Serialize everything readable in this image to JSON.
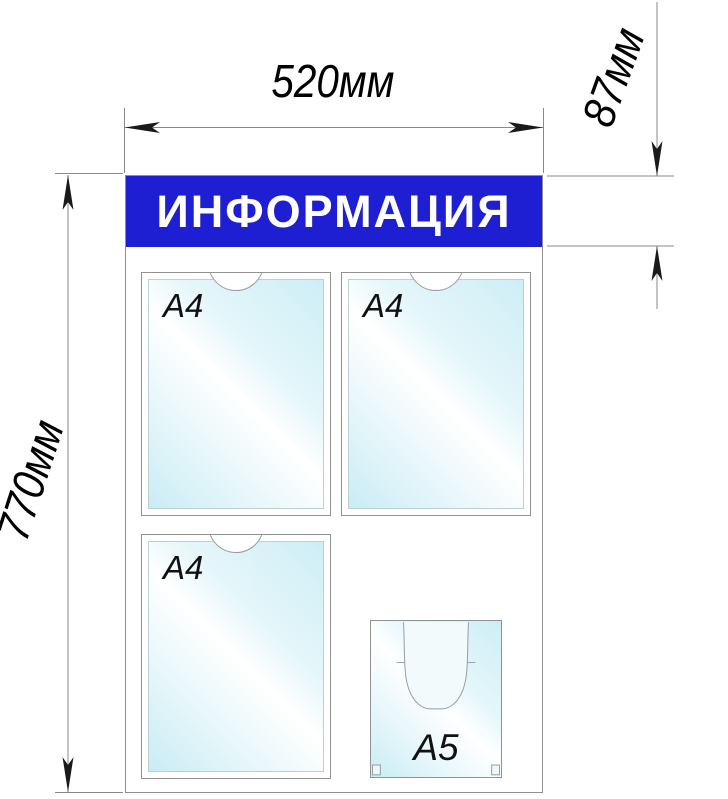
{
  "board": {
    "title": "ИНФОРМАЦИЯ",
    "pockets": [
      {
        "id": "pocket-a4-top-left",
        "type": "A4 flat pocket with finger notch",
        "label": "A4"
      },
      {
        "id": "pocket-a4-top-right",
        "type": "A4 flat pocket with finger notch",
        "label": "A4"
      },
      {
        "id": "pocket-a4-bottom-left",
        "type": "A4 flat pocket with finger notch",
        "label": "A4"
      },
      {
        "id": "pocket-a5-volume",
        "type": "A5 volume pocket",
        "label": "A5"
      }
    ]
  },
  "dimensions": {
    "width_label": "520мм",
    "header_label": "87мм",
    "height_label": "770мм"
  },
  "colors": {
    "banner_blue": "#1e1ed2",
    "banner_text": "#ffffff",
    "pocket_tint": "#cdeef6",
    "line_gray": "#8a8a8a",
    "arrow_black": "#1a1a1a"
  }
}
